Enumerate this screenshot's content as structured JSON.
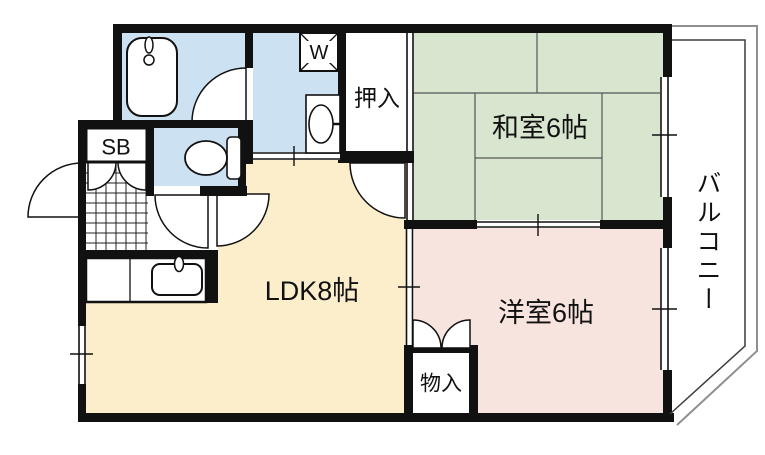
{
  "plan_title": "apartment-floorplan",
  "rooms": {
    "washitsu": {
      "label": "和室6帖",
      "floor_color": "#d8e6d0",
      "type": "japanese-tatami-room"
    },
    "yoshitsu": {
      "label": "洋室6帖",
      "floor_color": "#f8e4de",
      "type": "western-room"
    },
    "ldk": {
      "label": "LDK8帖",
      "floor_color": "#fcedcb",
      "type": "living-dining-kitchen"
    },
    "oshiire": {
      "label": "押入",
      "floor_color": "#ffffff",
      "type": "closet"
    },
    "monoire": {
      "label": "物入",
      "floor_color": "#ffffff",
      "type": "storage"
    },
    "balcony": {
      "label": "バルコニー",
      "floor_color": "#ffffff",
      "type": "balcony"
    },
    "shoebox": {
      "label": "SB",
      "floor_color": "#ffffff",
      "type": "shoe-box"
    },
    "washer_pan": {
      "label": "W",
      "floor_color": "#ffffff",
      "type": "washing-machine-pan"
    }
  },
  "wet_area_color": "#cce2f2",
  "wall_color": "#111111",
  "tatami_line_color": "#555555",
  "balcony_outer_line_color": "#8f8f8f",
  "balcony_inner_line_color": "#3c3c3c",
  "fixtures": [
    "bathtub",
    "wash-basin",
    "toilet",
    "kitchen-sink",
    "entrance-tile-grid"
  ],
  "door_symbols": [
    "front-door-swing",
    "bathroom-door-swing",
    "toilet-door-swing",
    "hall-ldk-door-swing",
    "hall-washitsu-door-swing",
    "shoebox-double-doors",
    "monoire-double-doors"
  ],
  "window_symbols": [
    "washitsu-right-window",
    "yoshitsu-right-window",
    "ldk-left-window",
    "washroom-sliding-entry",
    "oshiire-fusuma",
    "washitsu-yoshitsu-sliding",
    "ldk-yoshitsu-sliding"
  ]
}
